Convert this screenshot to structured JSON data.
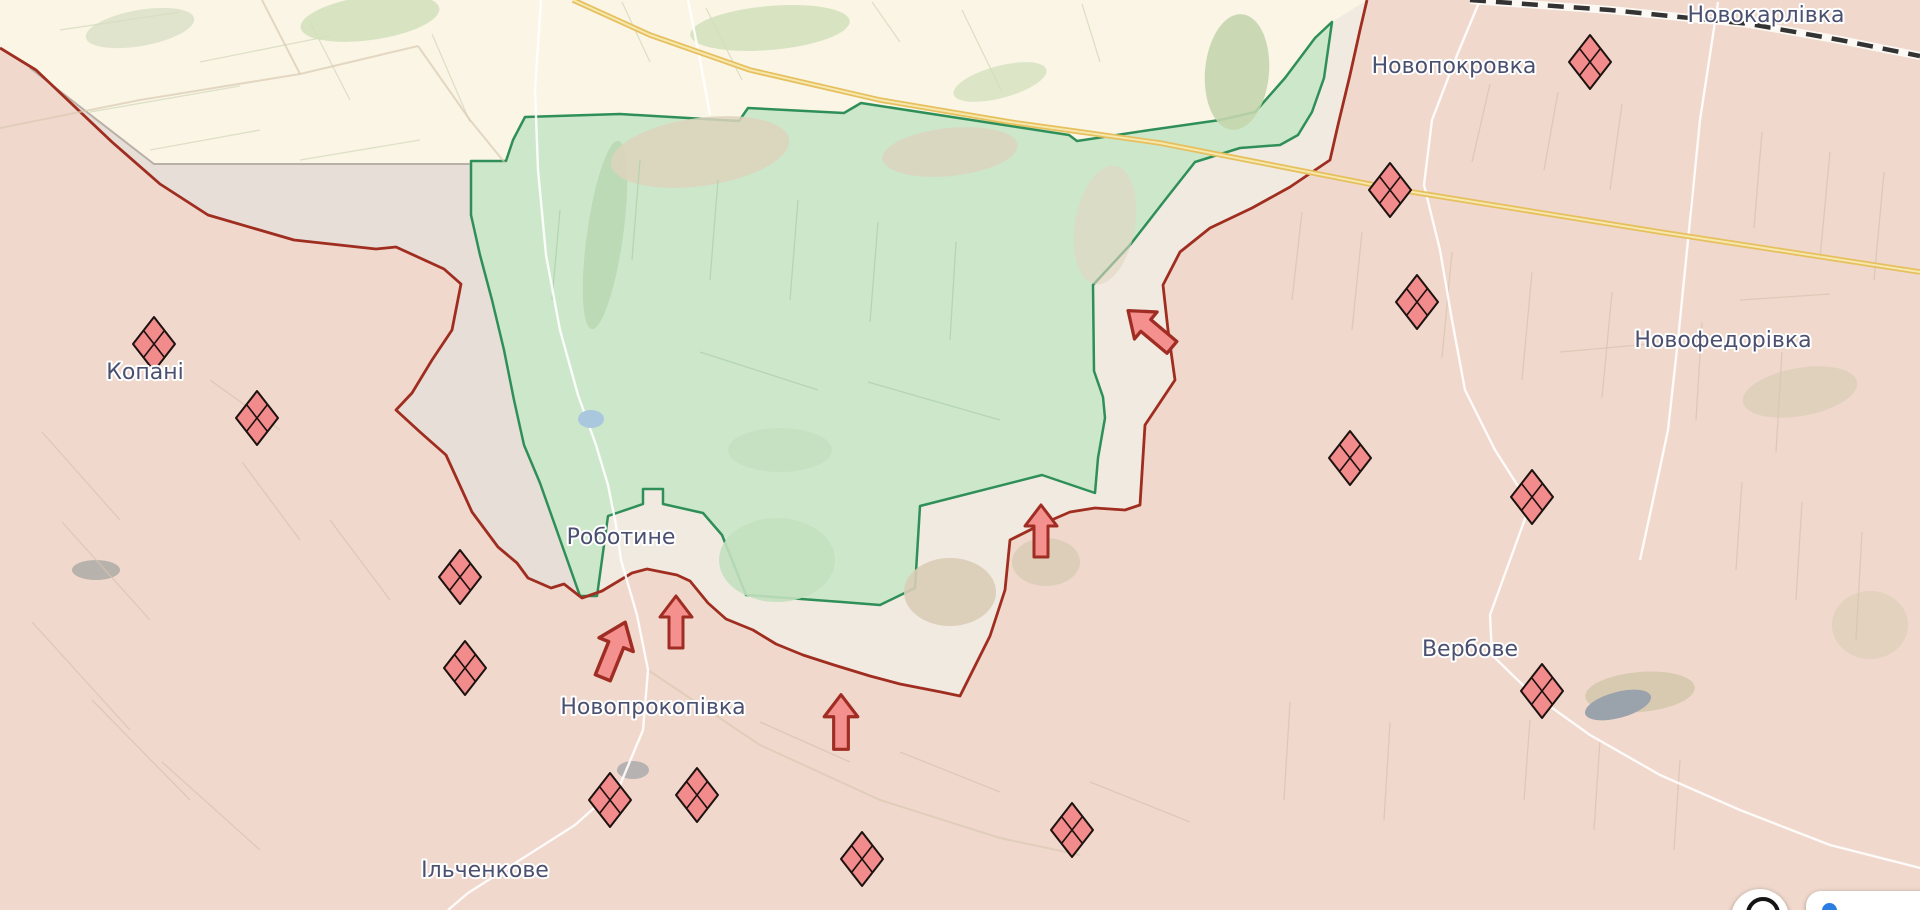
{
  "map": {
    "width": 1920,
    "height": 910,
    "colors": {
      "base": "#fbf5e6",
      "occupied_fill": "#f0d8cc",
      "occupied_border": "#9f2d20",
      "liberated_fill": "#cde7cb",
      "liberated_border": "#2f8f58",
      "grayzone_fill": "#f0e9df",
      "grayzone_dark": "#e4ddd6",
      "grayzone_border": "#b9b1a7",
      "railway": "#333333",
      "railway_casing": "#fdfdf8",
      "highway": "#e6c05e",
      "highway_core": "#f6e7ad",
      "road": "#ffffff",
      "label": "#4b5070",
      "marker_fill": "#f28b8b",
      "marker_stroke": "#1c1210",
      "arrow_fill": "#f4908d",
      "arrow_stroke": "#a02d24"
    },
    "places": [
      {
        "label": "Новокарлівка",
        "x": 1766,
        "y": 14
      },
      {
        "label": "Новопокровка",
        "x": 1454,
        "y": 65
      },
      {
        "label": "Новофедорівка",
        "x": 1723,
        "y": 339
      },
      {
        "label": "Копані",
        "x": 145,
        "y": 371
      },
      {
        "label": "Роботине",
        "x": 621,
        "y": 536
      },
      {
        "label": "Вербове",
        "x": 1470,
        "y": 648
      },
      {
        "label": "Новопрокопівка",
        "x": 653,
        "y": 706
      },
      {
        "label": "Ільченкове",
        "x": 485,
        "y": 869
      }
    ],
    "fortifications": [
      {
        "x": 154,
        "y": 344
      },
      {
        "x": 257,
        "y": 418
      },
      {
        "x": 460,
        "y": 577
      },
      {
        "x": 465,
        "y": 668
      },
      {
        "x": 610,
        "y": 800
      },
      {
        "x": 697,
        "y": 795
      },
      {
        "x": 862,
        "y": 859
      },
      {
        "x": 1072,
        "y": 830
      },
      {
        "x": 1590,
        "y": 62
      },
      {
        "x": 1390,
        "y": 190
      },
      {
        "x": 1417,
        "y": 302
      },
      {
        "x": 1350,
        "y": 458
      },
      {
        "x": 1532,
        "y": 497
      },
      {
        "x": 1542,
        "y": 691
      }
    ],
    "attack_arrows": [
      {
        "x": 1150,
        "y": 329,
        "rot": -50,
        "s": 1.1
      },
      {
        "x": 1041,
        "y": 531,
        "rot": 0,
        "s": 1.0
      },
      {
        "x": 676,
        "y": 622,
        "rot": 0,
        "s": 1.0
      },
      {
        "x": 614,
        "y": 650,
        "rot": 22,
        "s": 1.15
      },
      {
        "x": 841,
        "y": 722,
        "rot": 0,
        "s": 1.05
      }
    ]
  },
  "geometry": {
    "occupied_polygon": "0,48 36,70 112,142 160,184 208,215 294,240 376,249 396,247 444,269 461,284 452,330 432,360 412,393 396,410 420,432 446,455 472,512 498,547 517,563 528,578 551,588 564,584 582,598 602,591 632,573 647,569 677,575 690,581 708,603 726,619 753,630 776,644 803,655 834,665 870,676 900,684 941,692 960,696 990,636 1005,590 1010,540 1040,525 1070,512 1095,508 1125,510 1140,505 1145,425 1175,380 1168,330 1163,285 1180,252 1210,228 1252,208 1290,187 1330,160 1338,125 1350,75 1360,30 1367,0 1920,0 1920,910 0,910",
    "frontline": "0,48 36,70 112,142 160,184 208,215 294,240 376,249 396,247 444,269 461,284 452,330 432,360 412,393 396,410 420,432 446,455 472,512 498,547 517,563 528,578 551,588 564,584 582,598 602,591 632,573 647,569 677,575 690,581 708,603 726,619 753,630 776,644 803,655 834,665 870,676 900,684 941,692 960,696 990,636 1005,590 1010,540 1040,525 1070,512 1095,508 1125,510 1140,505 1145,425 1175,380 1168,330 1163,285 1180,252 1210,228 1252,208 1290,187 1330,160 1338,125 1350,75 1360,30 1367,0",
    "grayzone_polygon": "30,68 154,164 470,164 471,215 480,255 492,300 504,350 514,400 524,445 540,483 580,596 597,596 608,516 643,504 643,489 663,489 663,504 703,513 722,535 740,580 746,595 800,600 842,602 880,605 915,588 920,506 1042,475 1095,493 1098,458 1105,418 1103,397 1094,371 1093,285 1130,245 1165,200 1195,162 1240,148 1280,145 1298,135 1312,112 1324,78 1332,22 1367,0 1360,30 1350,75 1338,125 1330,160 1290,187 1252,208 1210,228 1180,252 1163,285 1168,330 1175,380 1145,425 1140,505 1125,510 1095,508 1070,512 1040,525 1010,540 1005,590 990,636 960,696 941,692 900,684 870,676 834,665 803,655 776,644 753,630 726,619 708,603 690,581 677,575 647,569 632,573 602,591 582,598 564,584 551,588 528,578 517,563 498,547 472,512 446,455 420,432 396,410 412,393 432,360 452,330 461,284 444,269 396,247 376,249 294,240 208,215 160,184 112,142 36,70",
    "grayzone_nw_polygon": "30,68 154,164 470,164 471,215 480,255 492,300 504,350 514,400 524,445 540,483 580,596 582,598 564,584 551,588 528,578 517,563 498,547 472,512 446,455 420,432 396,410 412,393 432,360 452,330 461,284 444,269 396,247 376,249 294,240 208,215 160,184 112,142 36,70",
    "liberated_polygon": "525,117 620,114 739,121 748,108 844,113 861,103 1069,135 1077,141 1150,130 1220,120 1255,112 1285,78 1315,38 1332,22 1324,78 1312,112 1298,135 1280,145 1240,148 1195,162 1165,200 1130,245 1093,285 1094,371 1103,397 1105,418 1098,458 1095,493 1042,475 920,506 915,588 880,605 842,602 746,595 740,580 722,535 703,513 663,504 663,489 643,489 643,504 608,516 597,596 580,596 540,483 524,445 514,400 504,350 492,300 480,255 471,215 471,161 506,161 513,140",
    "grayline": "30,68 154,164 470,164",
    "railway": "1470,0 1610,10 1750,24 1840,40 1920,56",
    "highway": "573,0 650,35 750,70 880,100 1010,122 1160,143 1400,190 1660,232 1920,272",
    "roads_white": [
      "541,0 535,90 538,170 546,255 560,330 578,395 596,445 608,485 616,525 621,560 637,615 648,670 643,730 620,785 575,825 520,860 468,893 448,910",
      "1480,0 1455,60 1432,120 1424,185 1440,250 1452,320 1465,390 1495,450 1530,505 1510,560 1490,615 1492,655 1530,692 1590,735 1660,775 1740,810 1830,845 1920,868",
      "1718,2 1700,120 1688,240 1678,340 1668,430 1652,505 1640,560",
      "688,0 700,60 710,115"
    ],
    "roads_faint": [
      "0,128 140,100 300,74 418,46",
      "418,46 470,120 505,163",
      "262,0 300,74",
      "648,670 760,745 880,800 1000,838 1080,855"
    ]
  },
  "decor": {
    "patches": [
      {
        "cx": 370,
        "cy": 18,
        "rx": 70,
        "ry": 22,
        "rot": -8,
        "fill": "#cfe0b8",
        "op": 0.8
      },
      {
        "cx": 770,
        "cy": 28,
        "rx": 80,
        "ry": 22,
        "rot": -5,
        "fill": "#cfe0b8",
        "op": 0.8
      },
      {
        "cx": 1000,
        "cy": 82,
        "rx": 48,
        "ry": 16,
        "rot": -15,
        "fill": "#cfe0b8",
        "op": 0.7
      },
      {
        "cx": 1237,
        "cy": 72,
        "rx": 32,
        "ry": 58,
        "rot": 5,
        "fill": "#c4d6ad",
        "op": 0.9
      },
      {
        "cx": 140,
        "cy": 28,
        "rx": 55,
        "ry": 18,
        "rot": -10,
        "fill": "#d6ddc0",
        "op": 0.7
      },
      {
        "cx": 605,
        "cy": 235,
        "rx": 18,
        "ry": 95,
        "rot": 8,
        "fill": "#b9d8b3",
        "op": 0.9
      },
      {
        "cx": 777,
        "cy": 560,
        "rx": 58,
        "ry": 42,
        "rot": 0,
        "fill": "#c3e0bf",
        "op": 0.9
      },
      {
        "cx": 780,
        "cy": 450,
        "rx": 52,
        "ry": 22,
        "rot": 0,
        "fill": "#c3e0bf",
        "op": 0.8
      },
      {
        "cx": 700,
        "cy": 152,
        "rx": 90,
        "ry": 34,
        "rot": -8,
        "fill": "#ddd3bd",
        "op": 0.85
      },
      {
        "cx": 950,
        "cy": 152,
        "rx": 68,
        "ry": 24,
        "rot": -6,
        "fill": "#ddd3bd",
        "op": 0.8
      },
      {
        "cx": 950,
        "cy": 592,
        "rx": 46,
        "ry": 34,
        "rot": 0,
        "fill": "#d9cdb6",
        "op": 0.9
      },
      {
        "cx": 1046,
        "cy": 562,
        "rx": 34,
        "ry": 24,
        "rot": 0,
        "fill": "#d9cdb6",
        "op": 0.9
      },
      {
        "cx": 1640,
        "cy": 692,
        "rx": 55,
        "ry": 20,
        "rot": -5,
        "fill": "#d5c9ae",
        "op": 0.9
      },
      {
        "cx": 1800,
        "cy": 392,
        "rx": 58,
        "ry": 24,
        "rot": -10,
        "fill": "#dcd0b8",
        "op": 0.8
      },
      {
        "cx": 1870,
        "cy": 625,
        "rx": 38,
        "ry": 34,
        "rot": 0,
        "fill": "#dcd0b8",
        "op": 0.7
      },
      {
        "cx": 1105,
        "cy": 225,
        "rx": 30,
        "ry": 60,
        "rot": 10,
        "fill": "#e3d6c2",
        "op": 0.6
      },
      {
        "cx": 633,
        "cy": 770,
        "rx": 16,
        "ry": 9,
        "rot": 0,
        "fill": "#ababab",
        "op": 0.85
      },
      {
        "cx": 96,
        "cy": 570,
        "rx": 24,
        "ry": 10,
        "rot": 0,
        "fill": "#a9aaa4",
        "op": 0.8
      }
    ],
    "ponds": [
      {
        "cx": 591,
        "cy": 419,
        "rx": 13,
        "ry": 9,
        "rot": 0,
        "fill": "#a9c7dd",
        "op": 1
      },
      {
        "cx": 1618,
        "cy": 705,
        "rx": 34,
        "ry": 13,
        "rot": -15,
        "fill": "#9aa2ab",
        "op": 1
      }
    ],
    "line_groups": [
      {
        "stroke": "#d9c4b2",
        "w": 1.3,
        "op": 0.75,
        "segs": [
          [
            1490,
            84,
            1472,
            162
          ],
          [
            1558,
            92,
            1544,
            170
          ],
          [
            1622,
            104,
            1610,
            190
          ],
          [
            1700,
            122,
            1690,
            210
          ],
          [
            1762,
            132,
            1754,
            228
          ],
          [
            1830,
            152,
            1820,
            258
          ],
          [
            1884,
            172,
            1874,
            280
          ],
          [
            1302,
            212,
            1292,
            300
          ],
          [
            1362,
            232,
            1352,
            330
          ],
          [
            1452,
            252,
            1442,
            358
          ],
          [
            1532,
            272,
            1522,
            380
          ],
          [
            1612,
            292,
            1602,
            398
          ],
          [
            1702,
            322,
            1696,
            420
          ],
          [
            1782,
            352,
            1776,
            452
          ],
          [
            1742,
            482,
            1736,
            570
          ],
          [
            1802,
            502,
            1796,
            600
          ],
          [
            1862,
            532,
            1856,
            640
          ],
          [
            1530,
            720,
            1524,
            800
          ],
          [
            1600,
            740,
            1594,
            830
          ],
          [
            1680,
            760,
            1674,
            850
          ],
          [
            42,
            432,
            120,
            520
          ],
          [
            62,
            522,
            150,
            620
          ],
          [
            32,
            622,
            130,
            730
          ],
          [
            92,
            700,
            190,
            800
          ],
          [
            162,
            762,
            260,
            850
          ],
          [
            242,
            462,
            300,
            540
          ],
          [
            330,
            520,
            390,
            600
          ],
          [
            210,
            380,
            280,
            430
          ],
          [
            760,
            722,
            850,
            762
          ],
          [
            900,
            752,
            1000,
            792
          ],
          [
            1090,
            782,
            1190,
            822
          ],
          [
            1290,
            702,
            1284,
            800
          ],
          [
            1390,
            722,
            1384,
            820
          ],
          [
            1560,
            352,
            1650,
            344
          ],
          [
            1740,
            300,
            1830,
            294
          ]
        ]
      },
      {
        "stroke": "#aed2ac",
        "w": 1.3,
        "op": 0.8,
        "segs": [
          [
            640,
            160,
            632,
            260
          ],
          [
            718,
            180,
            710,
            280
          ],
          [
            798,
            200,
            790,
            300
          ],
          [
            878,
            222,
            870,
            322
          ],
          [
            956,
            242,
            950,
            340
          ],
          [
            700,
            352,
            818,
            390
          ],
          [
            868,
            382,
            1000,
            420
          ],
          [
            560,
            210,
            552,
            300
          ]
        ]
      },
      {
        "stroke": "#d8ddc0",
        "w": 1.3,
        "op": 0.85,
        "segs": [
          [
            60,
            30,
            180,
            12
          ],
          [
            200,
            62,
            330,
            36
          ],
          [
            90,
            112,
            240,
            86
          ],
          [
            350,
            100,
            310,
            22
          ],
          [
            470,
            122,
            432,
            34
          ],
          [
            650,
            62,
            622,
            2
          ],
          [
            742,
            80,
            706,
            8
          ],
          [
            900,
            42,
            872,
            2
          ],
          [
            1002,
            92,
            962,
            10
          ],
          [
            1100,
            62,
            1082,
            4
          ],
          [
            150,
            150,
            260,
            130
          ],
          [
            300,
            160,
            420,
            140
          ]
        ]
      }
    ]
  },
  "ui": {
    "controls": [
      {
        "name": "map-control-button",
        "icon": "circle-tool-icon"
      },
      {
        "name": "attribution-pill",
        "icon": "info-icon"
      }
    ]
  }
}
